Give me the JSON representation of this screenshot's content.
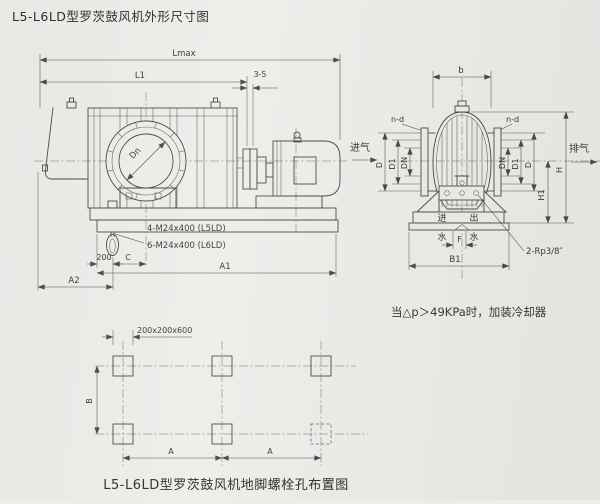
{
  "title": "L5-L6LD型罗茨鼓风机外形尺寸图",
  "side_view": {
    "dim_lmax": "Lmax",
    "dim_l1": "L1",
    "dim_gap": "3-5",
    "dim_dn": "Dn",
    "dim_200": "200",
    "dim_c": "C",
    "dim_a1": "A1",
    "dim_a2": "A2",
    "anchor_note_l5": "4-M24x400 (L5LD)",
    "anchor_note_l6": "6-M24x400 (L6LD)"
  },
  "end_view": {
    "dim_b": "b",
    "dim_nd_left": "n-d",
    "dim_nd_right": "n-d",
    "dim_d_left": "D",
    "dim_d1_left": "D1",
    "dim_dn_left": "DN",
    "dim_dn_right": "DN",
    "dim_d1_right": "D1",
    "dim_d_right": "D",
    "dim_h": "H",
    "dim_h1": "H1",
    "dim_b1": "B1",
    "dim_f": "F",
    "label_intake": "进气",
    "label_exhaust": "排气",
    "label_water_in_1": "进",
    "label_water_in_2": "水",
    "label_water_out_1": "出",
    "label_water_out_2": "水",
    "label_thread": "2-Rp3/8″"
  },
  "cooler_note": "当△p＞49KPa时，加装冷却器",
  "foundation_view": {
    "dim_block": "200x200x600",
    "dim_b": "B",
    "dim_a_left": "A",
    "dim_a_right": "A",
    "caption": "L5-L6LD型罗茨鼓风机地脚螺栓孔布置图"
  }
}
